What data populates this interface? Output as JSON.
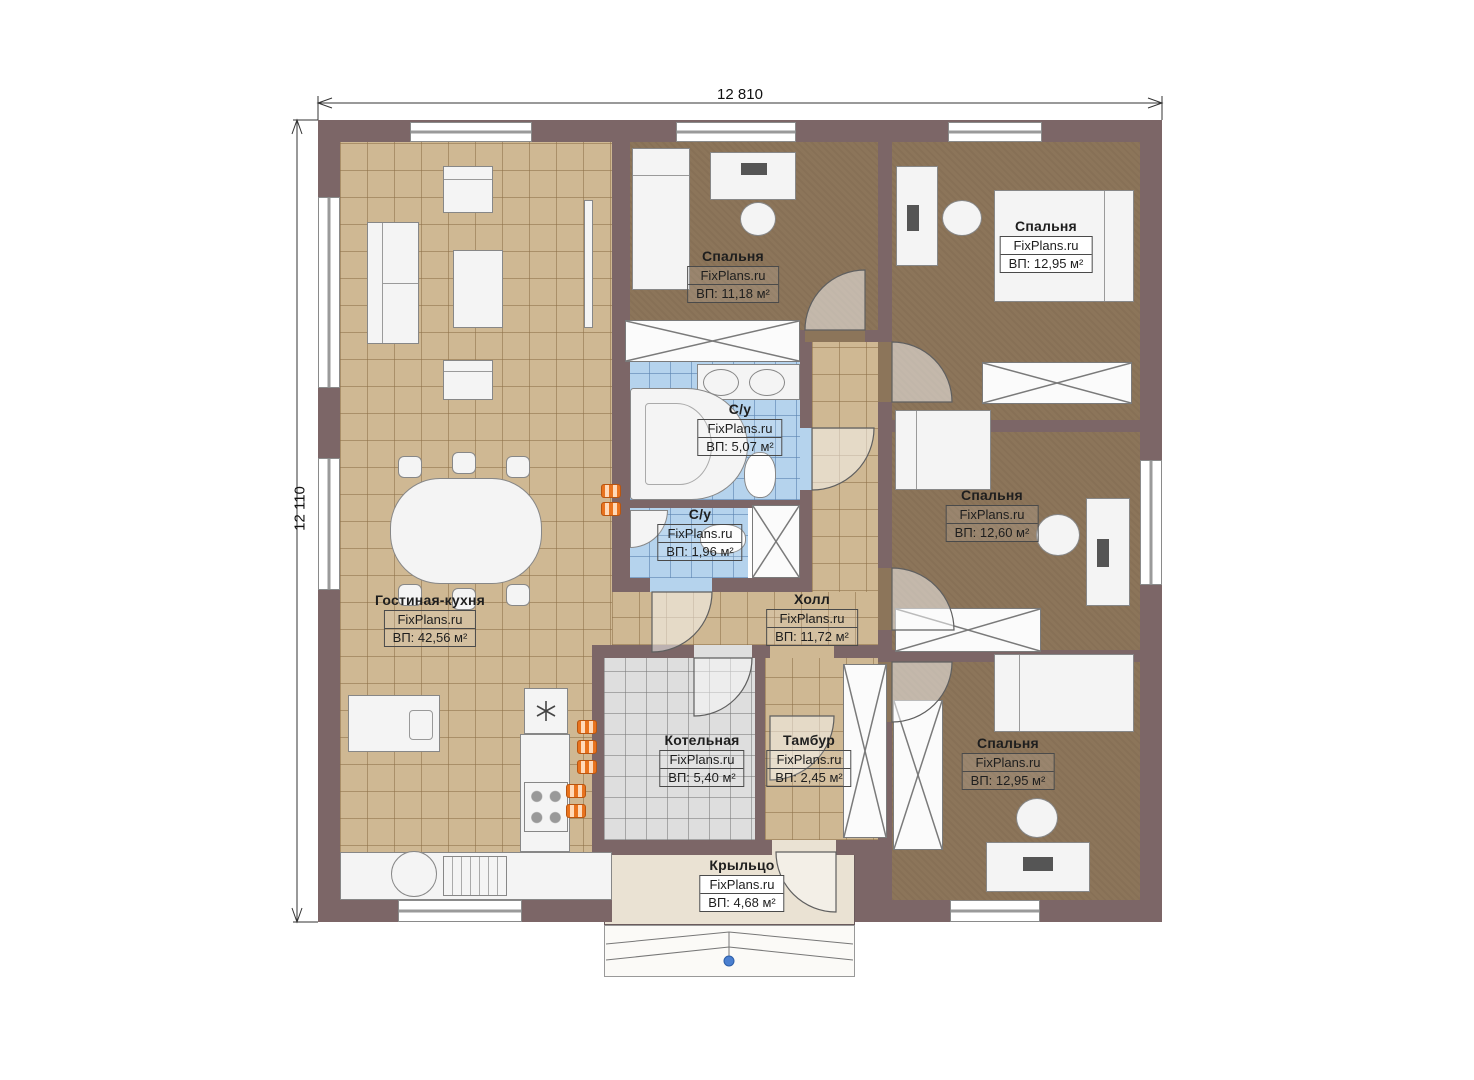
{
  "plan": {
    "dimension_width_label": "12 810",
    "dimension_height_label": "12 110",
    "watermark": "FixPlans.ru",
    "rooms": [
      {
        "key": "bedroom-top",
        "name": "Спальня",
        "watermark": "FixPlans.ru",
        "area": "ВП: 11,18 м²"
      },
      {
        "key": "bedroom-top-right",
        "name": "Спальня",
        "watermark": "FixPlans.ru",
        "area": "ВП: 12,95 м²"
      },
      {
        "key": "bathroom-main",
        "name": "С/у",
        "watermark": "FixPlans.ru",
        "area": "ВП: 5,07 м²"
      },
      {
        "key": "bathroom-small",
        "name": "С/у",
        "watermark": "FixPlans.ru",
        "area": "ВП: 1,96 м²"
      },
      {
        "key": "bedroom-right",
        "name": "Спальня",
        "watermark": "FixPlans.ru",
        "area": "ВП: 12,60 м²"
      },
      {
        "key": "living-kitchen",
        "name": "Гостиная-кухня",
        "watermark": "FixPlans.ru",
        "area": "ВП: 42,56 м²"
      },
      {
        "key": "hall",
        "name": "Холл",
        "watermark": "FixPlans.ru",
        "area": "ВП: 11,72 м²"
      },
      {
        "key": "boiler-room",
        "name": "Котельная",
        "watermark": "FixPlans.ru",
        "area": "ВП: 5,40 м²"
      },
      {
        "key": "vestibule",
        "name": "Тамбур",
        "watermark": "FixPlans.ru",
        "area": "ВП: 2,45 м²"
      },
      {
        "key": "bedroom-bottom-right",
        "name": "Спальня",
        "watermark": "FixPlans.ru",
        "area": "ВП: 12,95 м²"
      },
      {
        "key": "porch",
        "name": "Крыльцо",
        "watermark": "FixPlans.ru",
        "area": "ВП: 4,68 м²"
      }
    ],
    "colors": {
      "wall": "#7c6667",
      "floor_tile": "#cfb893",
      "floor_bedroom": "#8c755a",
      "floor_bath": "#b5d3ed",
      "floor_boiler": "#dedede",
      "floor_porch": "#eae2d3",
      "accent_orange": "#e8731e",
      "marker_blue": "#4a7fd0"
    }
  }
}
